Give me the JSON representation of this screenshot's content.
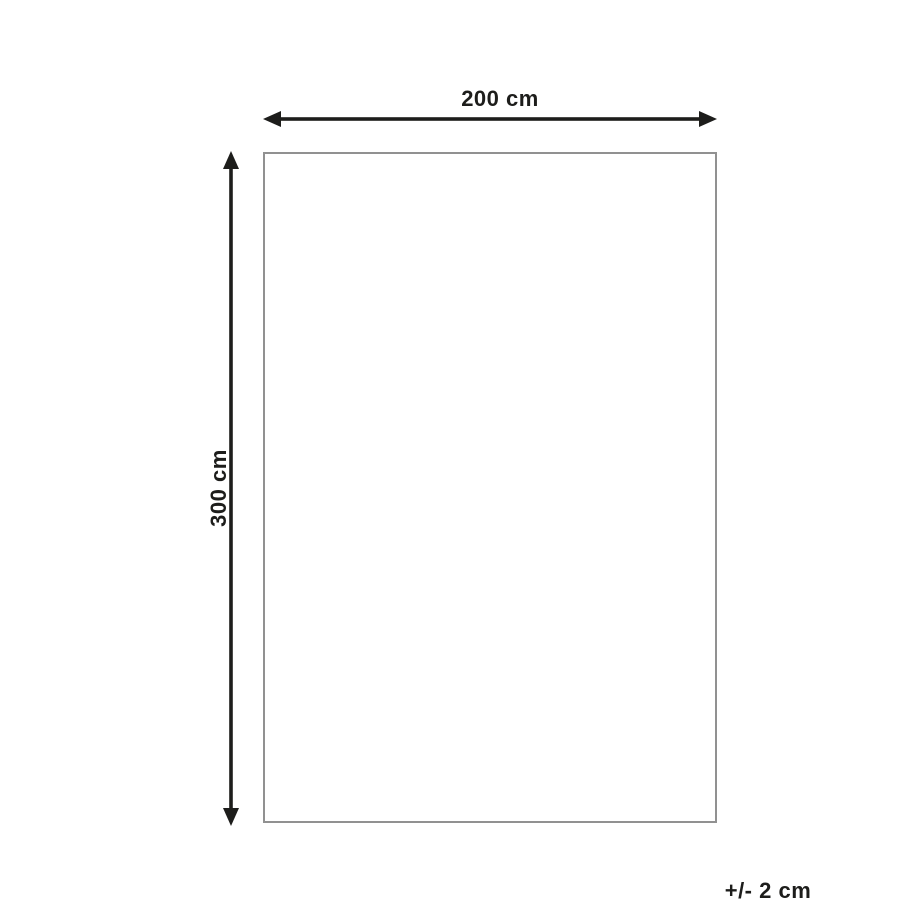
{
  "diagram": {
    "type": "product-dimension-diagram",
    "shape": "rectangle",
    "width_label": "200 cm",
    "height_label": "300 cm",
    "tolerance_label": "+/- 2 cm",
    "colors": {
      "background": "#ffffff",
      "arrow_and_text": "#1d1d1b",
      "outline_border": "#919191"
    }
  }
}
